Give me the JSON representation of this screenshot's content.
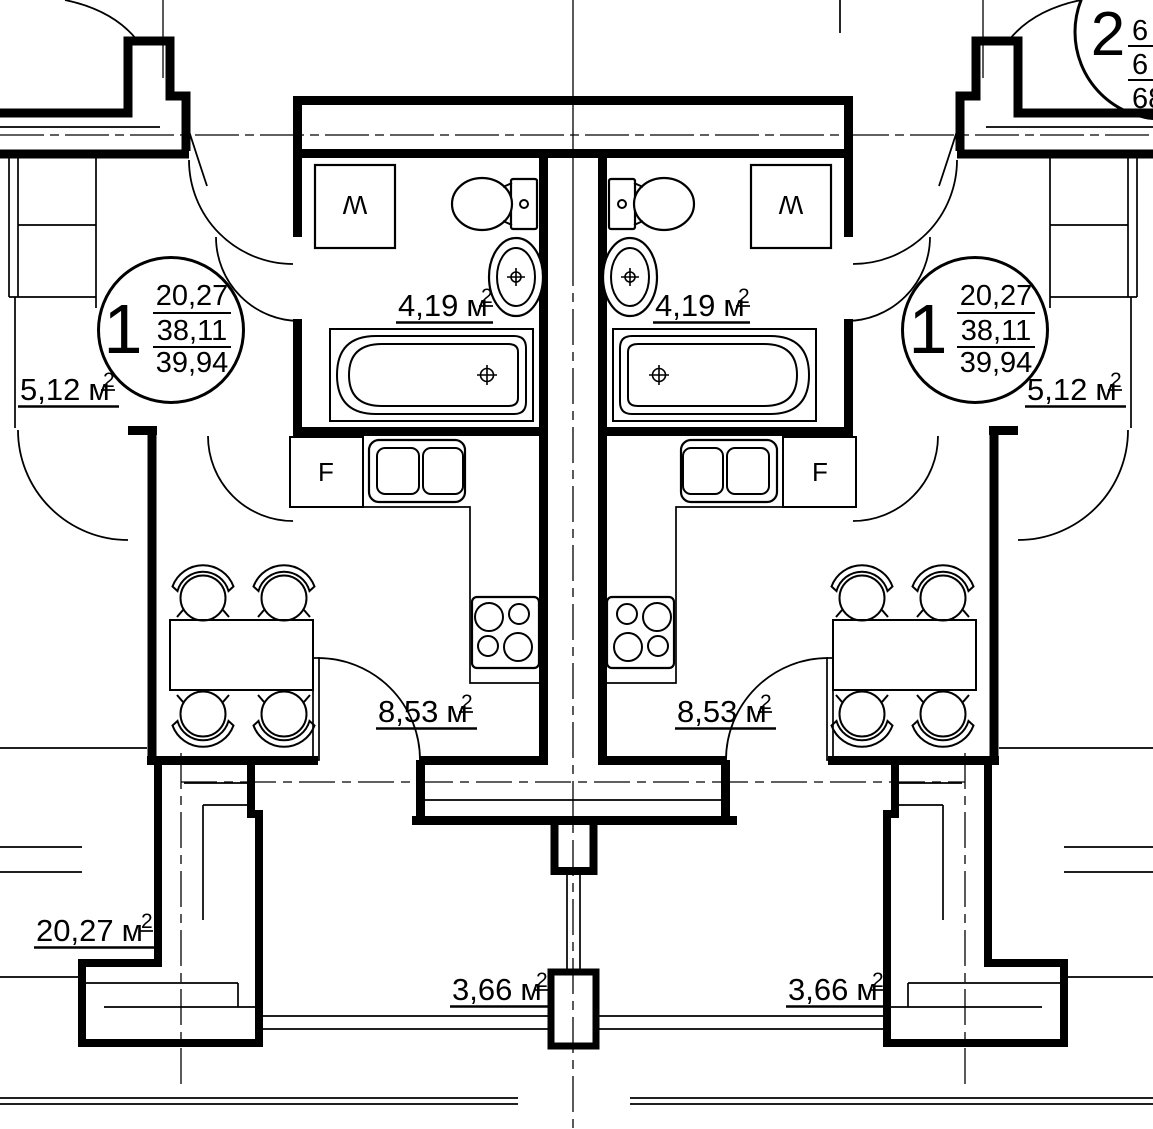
{
  "drawing": {
    "kind": "architectural floor plan",
    "background_color": "#ffffff",
    "line_color": "#000000"
  },
  "unit": {
    "main_suffix": "м",
    "sup": "2"
  },
  "rooms": {
    "bathroom_left": "4,19",
    "bathroom_right": "4,19",
    "hallway_left": "5,12",
    "hallway_right": "5,12",
    "kitchen_left": "8,53",
    "kitchen_right": "8,53",
    "living_room_left": "20,27",
    "balcony_left": "3,66",
    "balcony_right": "3,66"
  },
  "apartment_type_1": {
    "number": "1",
    "area_living": "20,27",
    "area_total": "38,11",
    "area_total_with_balcony": "39,94"
  },
  "apartment_type_2": {
    "number": "2",
    "visible_fragments": [
      "6",
      "6",
      "68"
    ]
  },
  "fixtures": {
    "washer_label": "W",
    "fridge_label": "F"
  }
}
